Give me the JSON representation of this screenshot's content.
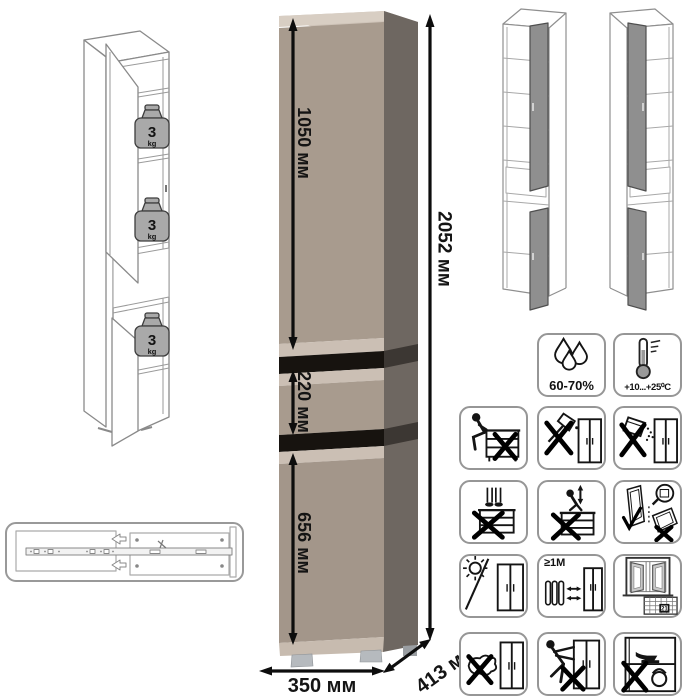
{
  "dimensions": {
    "top_section": "1050 мм",
    "drawer_section": "220 мм",
    "bottom_section": "656 мм",
    "total_height": "2052 мм",
    "width": "350 мм",
    "depth": "413 мм"
  },
  "shelf_load_badges": [
    {
      "value": "3",
      "unit": "kg"
    },
    {
      "value": "3",
      "unit": "kg"
    },
    {
      "value": "3",
      "unit": "kg"
    }
  ],
  "icon_tiles": [
    {
      "name": "humidity-range",
      "label": "60-70%"
    },
    {
      "name": "temperature-range",
      "label": "+10...+25⁰C"
    },
    {
      "name": "no-sitting",
      "label": ""
    },
    {
      "name": "no-sharp-tools",
      "label": ""
    },
    {
      "name": "no-spilling-liquids",
      "label": ""
    },
    {
      "name": "no-standing",
      "label": ""
    },
    {
      "name": "no-jumping",
      "label": ""
    },
    {
      "name": "transport-upright",
      "label": ""
    },
    {
      "name": "avoid-direct-sunlight",
      "label": ""
    },
    {
      "name": "heat-source-distance",
      "label": "≥1M"
    },
    {
      "name": "ventilation-acclimatization",
      "label": "21"
    },
    {
      "name": "no-wet-cleaning",
      "label": ""
    },
    {
      "name": "no-dragging",
      "label": ""
    },
    {
      "name": "no-overloading",
      "label": ""
    }
  ],
  "colors": {
    "front": "#a89b8e",
    "front_lower": "#a3968a",
    "top_face": "#cfc4b9",
    "top_edge": "#d8cec3",
    "bevel": "#cbbfb4",
    "gap": "#17130f",
    "side": "#6e6761",
    "side_band": "#3c3733",
    "plinth": "#c7bbaf",
    "feet": "#b6babe",
    "door_panel": "#8f8f8f",
    "line_art": "#8a8a8a",
    "ink": "#141414"
  }
}
